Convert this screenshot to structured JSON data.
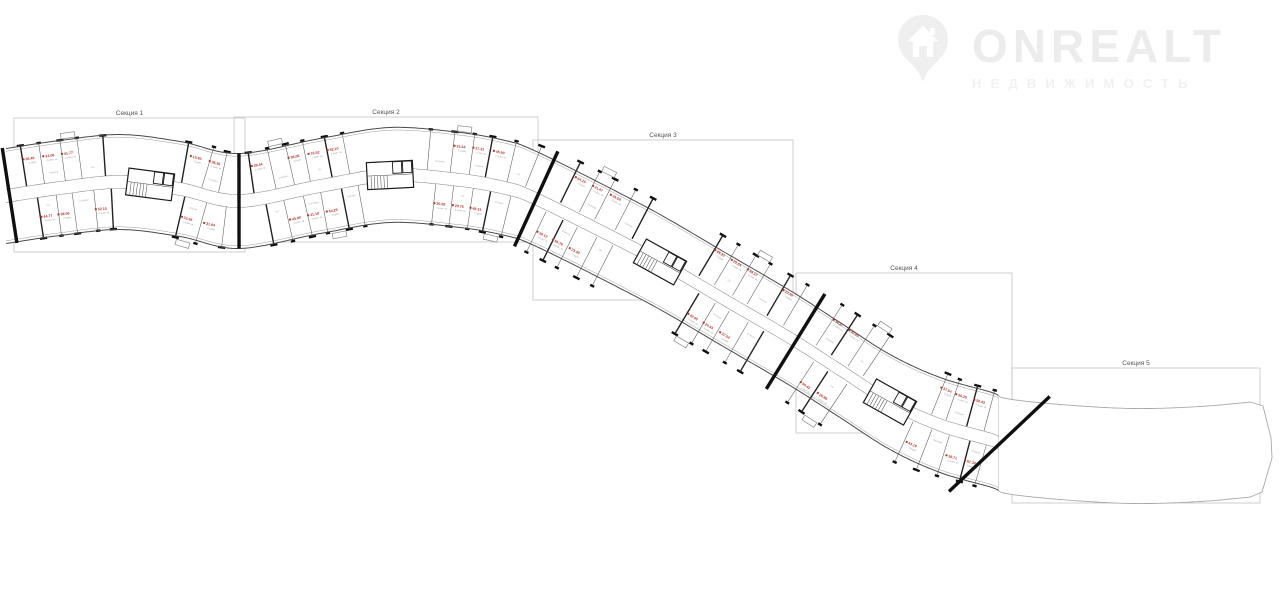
{
  "page": {
    "width": 1280,
    "height": 590,
    "background": "#ffffff"
  },
  "watermark": {
    "brand": "ONREALT",
    "subtitle": "НЕДВИЖИМОСТЬ",
    "color": "#ececec",
    "subtitle_color": "#f1f1f1",
    "icon": "house-location-pin"
  },
  "plan": {
    "sections": [
      {
        "label": "Секция 1",
        "box": [
          14,
          118,
          231,
          134
        ]
      },
      {
        "label": "Секция 2",
        "box": [
          234,
          117,
          304,
          125
        ]
      },
      {
        "label": "Секция 3",
        "box": [
          533,
          140,
          260,
          160
        ]
      },
      {
        "label": "Секция 4",
        "box": [
          796,
          273,
          216,
          160
        ]
      },
      {
        "label": "Секция 5",
        "box": [
          1012,
          368,
          248,
          135
        ]
      }
    ],
    "colors": {
      "outline": "#4a4a4a",
      "inner_edge": "#8d8d8d",
      "partition": "#5a5a5a",
      "thick_partition": "#222222",
      "thick_wall": "#101010",
      "corridor": "#8a8a8a",
      "box_border": "#c4c4c4",
      "section_label": "#555555",
      "unit_red": "#b03a30",
      "unit_gray": "#9a9a9a",
      "ghost_outline": "#a8a8a8"
    },
    "centerline": [
      [
        6,
        196
      ],
      [
        60,
        188
      ],
      [
        120,
        182
      ],
      [
        180,
        189
      ],
      [
        239,
        201
      ],
      [
        320,
        186
      ],
      [
        390,
        175
      ],
      [
        460,
        180
      ],
      [
        505,
        188
      ],
      [
        532,
        197
      ],
      [
        595,
        228
      ],
      [
        660,
        262
      ],
      [
        725,
        300
      ],
      [
        790,
        338
      ],
      [
        840,
        370
      ],
      [
        890,
        402
      ],
      [
        940,
        425
      ],
      [
        992,
        440
      ],
      [
        1006,
        446
      ],
      [
        1060,
        452
      ],
      [
        1133,
        456
      ],
      [
        1200,
        454
      ],
      [
        1256,
        449
      ]
    ],
    "half_width": 47.5,
    "corridor_half": 6.5,
    "detail_end_x": 999,
    "cores_x": [
      150,
      390,
      660,
      888
    ],
    "boundary_walls_x": [
      8,
      239,
      535,
      793
    ],
    "partition_spacings": [
      18,
      21,
      17,
      23,
      19,
      16,
      22,
      18,
      20
    ],
    "cap_points": [
      [
        1263,
        406
      ],
      [
        1271,
        438
      ],
      [
        1272,
        458
      ],
      [
        1262,
        492
      ]
    ],
    "unit_areas": [
      "36.46",
      "24.08",
      "41.77",
      "58.63",
      "19.80",
      "36.35",
      "28.44",
      "44.77",
      "38.06",
      "33.52",
      "52.10",
      "22.95",
      "31.64",
      "27.31",
      "45.90",
      "31.18",
      "64.25",
      "21.47",
      "35.08",
      "29.76",
      "48.33",
      "25.64",
      "39.12",
      "56.78",
      "23.40",
      "34.87",
      "42.65",
      "20.93",
      "37.54",
      "30.26",
      "50.42",
      "26.88",
      "43.19",
      "24.55",
      "38.71",
      "61.34",
      "22.16",
      "32.90",
      "46.58",
      "28.07"
    ],
    "unit_types": [
      "Студия",
      "1-комн. кв.",
      "2-комн. кв.",
      "3-комн. кв."
    ],
    "room_names": [
      "Кухня",
      "Спальня",
      "Прихожая",
      "С/у",
      "Лоджия",
      "Гостиная"
    ]
  }
}
